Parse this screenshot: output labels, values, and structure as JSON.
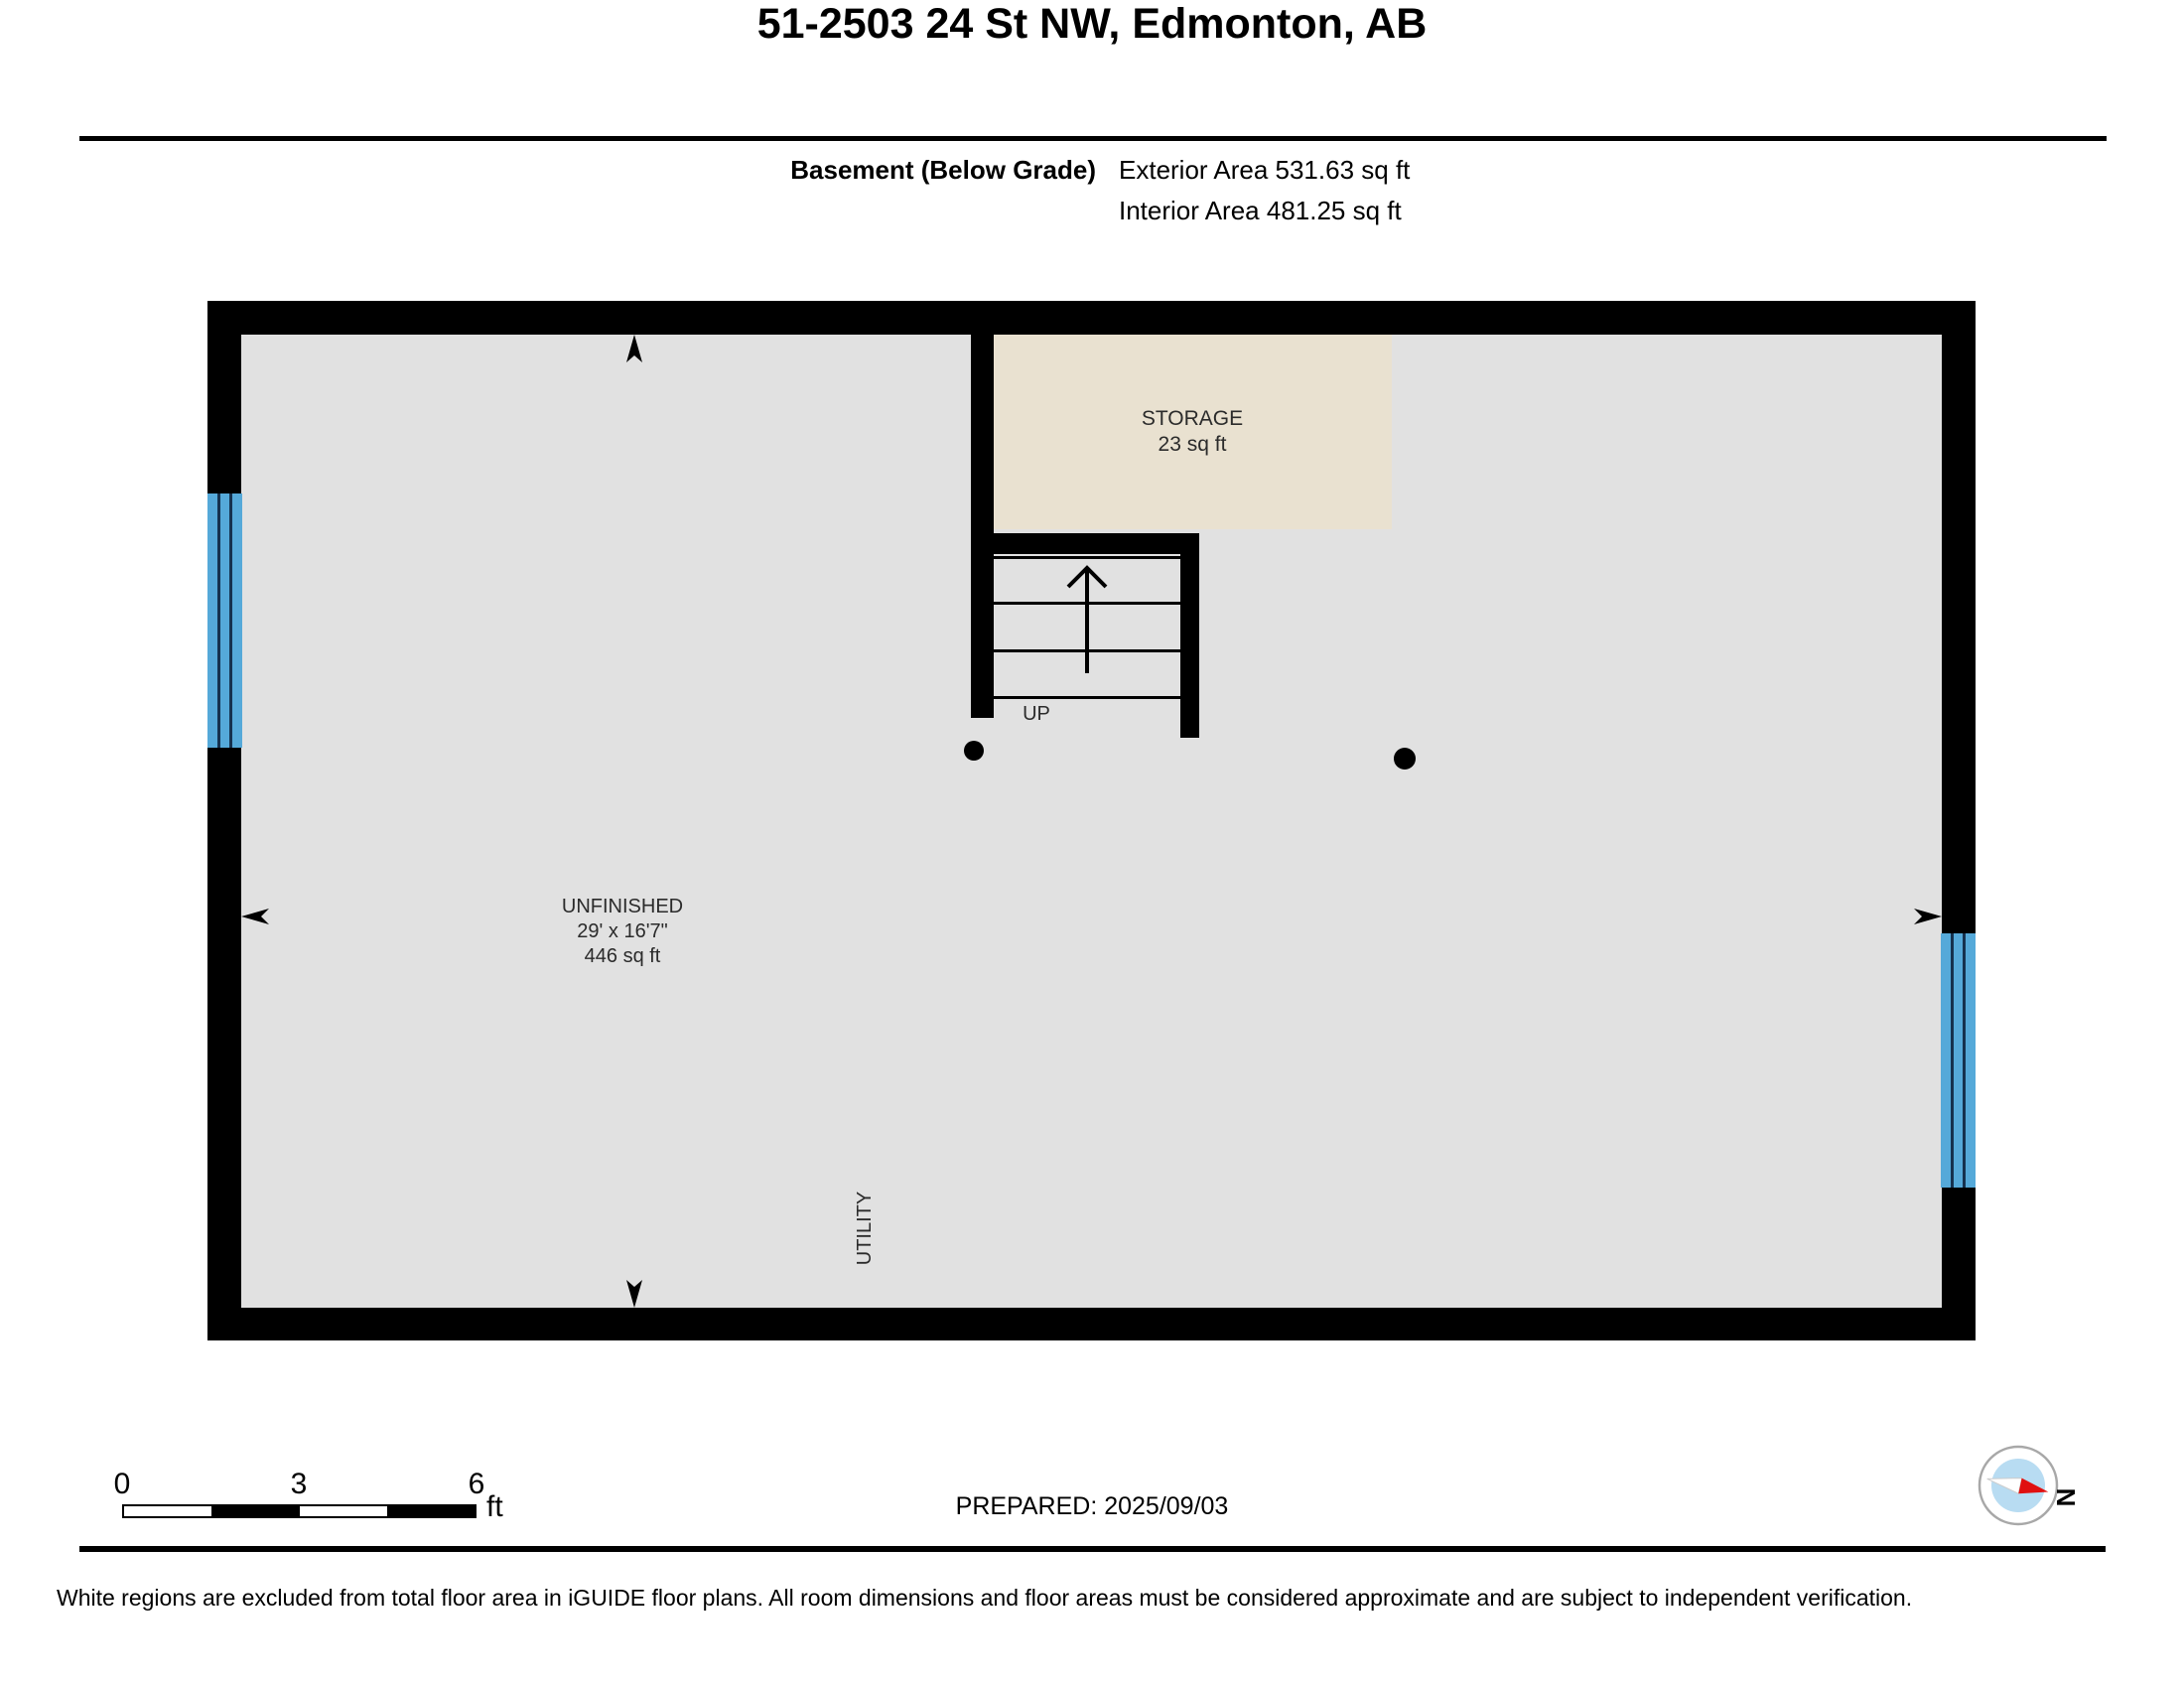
{
  "header": {
    "title": "51-2503 24 St NW, Edmonton, AB",
    "floor_label": "Basement (Below Grade)",
    "exterior_area": "Exterior Area 531.63 sq ft",
    "interior_area": "Interior Area 481.25 sq ft"
  },
  "plan": {
    "rooms": [
      {
        "name": "STORAGE",
        "area": "23 sq ft"
      },
      {
        "name": "UNFINISHED",
        "dimensions": "29' x 16'7\"",
        "area": "446 sq ft"
      },
      {
        "name": "UTILITY"
      }
    ],
    "stairs": {
      "label": "UP"
    },
    "colors": {
      "wall": "#000000",
      "floor": "#e1e1e1",
      "excluded_room_fill": "#e9e1d0",
      "window_blue": "#55a9d9",
      "window_frame": "#16324f"
    }
  },
  "footer": {
    "scale": {
      "ticks": [
        "0",
        "3",
        "6"
      ],
      "unit": "ft"
    },
    "prepared": "PREPARED: 2025/09/03",
    "compass_label": "N",
    "compass_colors": {
      "ring": "#a8a8a8",
      "face": "#b8dcf2",
      "needle_red": "#e01010",
      "needle_white": "#ffffff"
    },
    "disclaimer": "White regions are excluded from total floor area in iGUIDE floor plans. All room dimensions and floor areas must be considered approximate and are subject to independent verification."
  }
}
